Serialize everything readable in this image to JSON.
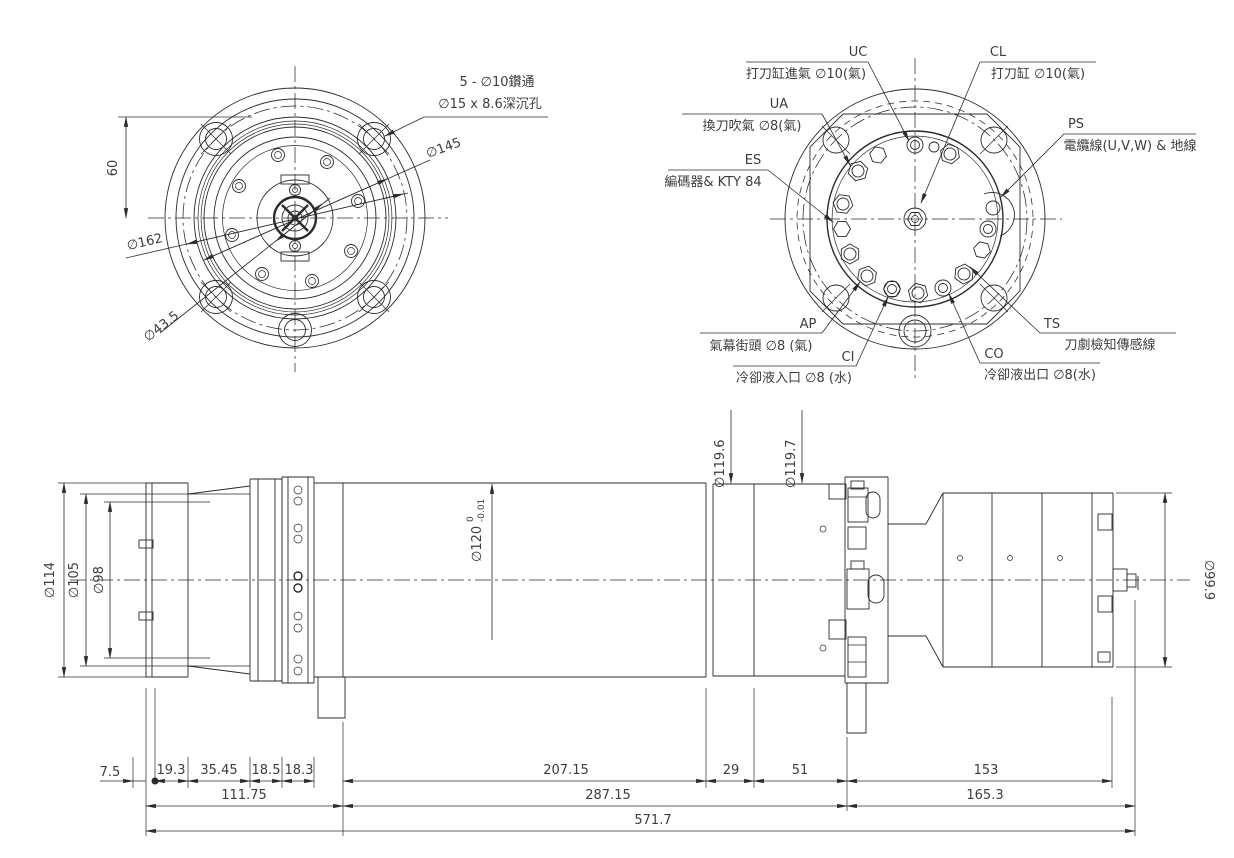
{
  "colors": {
    "background": "#ffffff",
    "line": "#2b2b2b",
    "text": "#3d3d3d"
  },
  "front_view": {
    "note_line1": "5 - ∅10鑽通",
    "note_line2": "∅15 x 8.6深沉孔",
    "dia_145": "∅145",
    "dia_162": "∅162",
    "dia_43_5": "∅43.5",
    "dim_60": "60"
  },
  "rear_view": {
    "ports": [
      {
        "code": "UC",
        "desc": "打刀缸進氣 ∅10(氣)"
      },
      {
        "code": "CL",
        "desc": "打刀缸 ∅10(氣)"
      },
      {
        "code": "UA",
        "desc": "換刀吹氣 ∅8(氣)"
      },
      {
        "code": "ES",
        "desc": "編碼器& KTY 84"
      },
      {
        "code": "PS",
        "desc": "電纜線(U,V,W) & 地線"
      },
      {
        "code": "TS",
        "desc": "刀劇檢知傳感線"
      },
      {
        "code": "CO",
        "desc": "冷卻液出口 ∅8(水)"
      },
      {
        "code": "CI",
        "desc": "冷卻液入口 ∅8 (水)"
      },
      {
        "code": "AP",
        "desc": "氣幕街頭 ∅8 (氣)"
      }
    ]
  },
  "side_view": {
    "dia_114": "∅114",
    "dia_105": "∅105",
    "dia_98": "∅98",
    "dia_119_6": "∅119.6",
    "dia_119_7": "∅119.7",
    "dia_120": "∅120",
    "dia_120_tol_upper": "0",
    "dia_120_tol_lower": "-0.01",
    "dia_99_9": "∅99.9",
    "row1": [
      "7.5",
      "19.3",
      "35.45",
      "18.5",
      "18.3",
      "207.15",
      "29",
      "51",
      "153"
    ],
    "row2": [
      "111.75",
      "287.15",
      "165.3"
    ],
    "total": "571.7"
  }
}
